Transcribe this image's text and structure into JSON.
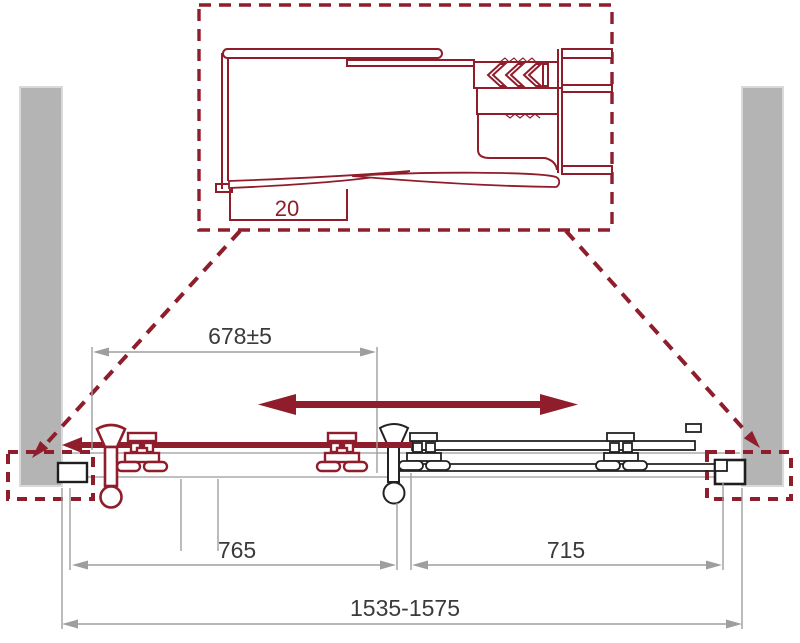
{
  "diagram": {
    "description": "Technical installation drawing (plan view) of a sliding shower door between two walls, with a magnified detail inset of the wall-profile / seal section",
    "colors": {
      "accent_red": "#8f1d2b",
      "wall_gray": "#b4b4b4",
      "wall_border": "#d9d9d9",
      "dimension_line_gray": "#9e9e9e",
      "dimension_text": "#3a3a3a",
      "fixed_panel_black": "#222222",
      "rail_gray": "#ababab",
      "background": "#ffffff"
    },
    "detail": {
      "dimension_label": "20"
    },
    "dims": {
      "top": "678±5",
      "left": "765",
      "right": "715",
      "total": "1535-1575"
    }
  }
}
